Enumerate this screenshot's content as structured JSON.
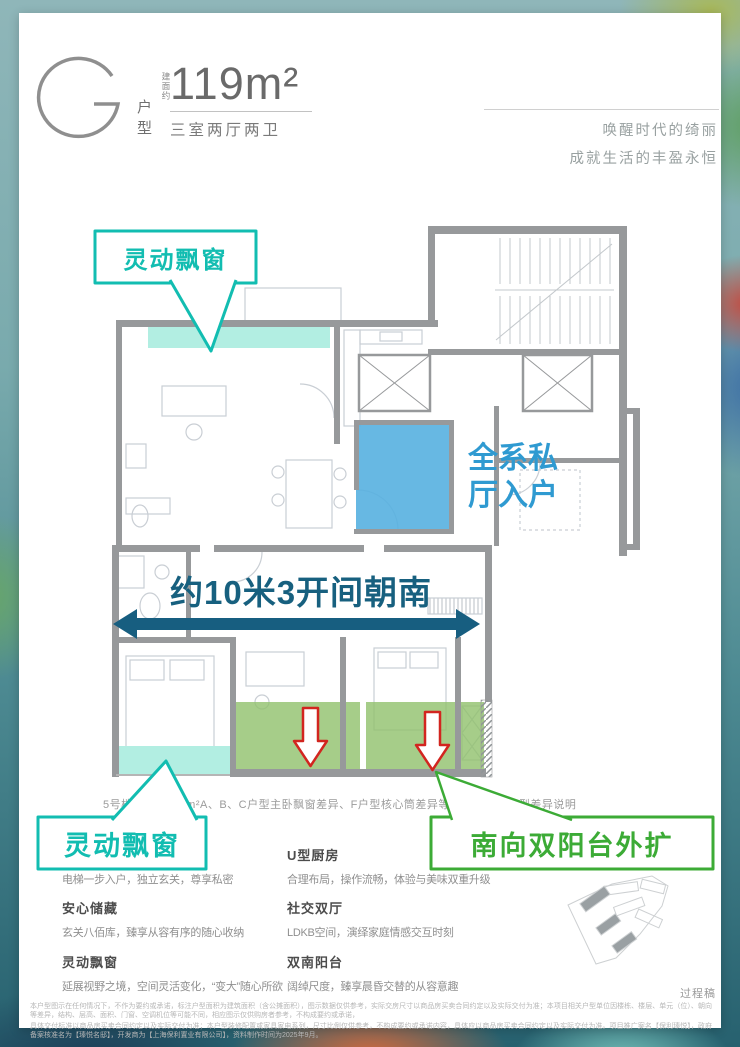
{
  "header": {
    "type_letter": "G",
    "type_label": "户型",
    "area_prefix": "建面约",
    "area_value": "119m²",
    "layout": "三室两厅两卫",
    "tagline_line1": "唤醒时代的绮丽",
    "tagline_line2": "成就生活的丰盈永恒"
  },
  "plan": {
    "callout_bay_top": "灵动飘窗",
    "callout_bay_bottom": "灵动飘窗",
    "callout_balcony": "南向双阳台外扩",
    "label_private_hall_line1": "全系私",
    "label_private_hall_line2": "厅入户",
    "label_south_span": "约10米3开间朝南",
    "caption": "5号楼（均）119m²A、B、C户型主卧飘窗差异、F户型核心筒差异等情形，详见户型差异说明"
  },
  "features": {
    "left": [
      {
        "title": "私厅入户",
        "desc": "电梯一步入户，独立玄关，尊享私密"
      },
      {
        "title": "安心储藏",
        "desc": "玄关八佰库，臻享从容有序的随心收纳"
      },
      {
        "title": "灵动飘窗",
        "desc": "延展视野之境，空间灵活变化，“变大”随心所欲"
      }
    ],
    "right": [
      {
        "title": "U型厨房",
        "desc": "合理布局，操作流畅，体验与美味双重升级"
      },
      {
        "title": "社交双厅",
        "desc": "LDKB空间，演绎家庭情感交互时刻"
      },
      {
        "title": "双南阳台",
        "desc": "阔绰尺度，臻享晨昏交替的从容意趣"
      }
    ]
  },
  "footer": {
    "draft_label": "过程稿",
    "disclaimer_line1": "本户型图示在任何情况下，不作为要约或承诺，标注户型面积为建筑面积（含公摊面积），图示数据仅供参考，实际交房尺寸以商品房买卖合同约定以及实际交付为准；本项目相关户型单位因楼栋、楼层、单元（位）、朝向等差异，结构、层高、面积、门窗、空调机位等可能不同，相应图示仅供购房者参考，不构成要约或承诺，",
    "disclaimer_line2": "具体交付标准以商品房买卖合同约定以及实际交付为准；本户型装修配置或家具家电系列，尺寸比例仅供参考，不构成要约或承诺内容，具体应以商品房买卖合同约定以及实际交付为准。项目推广案名【保利瑧悦】，政府备案核准名为【瑧悦名邸】，开发商为【上海保利置业有限公司】，资料制作时间为2025年9月。"
  },
  "colors": {
    "accent_teal": "#12bdb1",
    "accent_blue": "#2f9ad1",
    "accent_green": "#3cab36",
    "accent_red": "#d2251f",
    "dimension_arrow": "#175e80",
    "highlight_teal": "#b2eee2",
    "highlight_blue": "#57b0e0",
    "highlight_green": "#90c16b"
  }
}
